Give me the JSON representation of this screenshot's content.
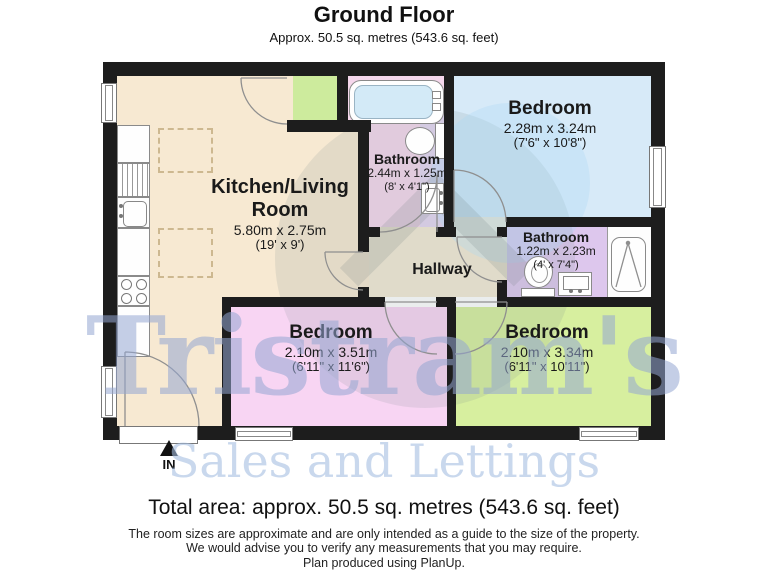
{
  "header": {
    "title": "Ground Floor",
    "subtitle": "Approx. 50.5 sq. metres (543.6 sq. feet)"
  },
  "rooms": {
    "kitchen": {
      "name": "Kitchen/Living Room",
      "dims": "5.80m x 2.75m",
      "imperial": "(19' x 9')",
      "color": "#f7e9d2"
    },
    "bathroom_top": {
      "name": "Bathroom",
      "dims": "2.44m x 1.25m",
      "imperial": "(8' x 4'1\")",
      "color": "#f5d7ec",
      "accent": "#e4d6f1"
    },
    "bedroom_top": {
      "name": "Bedroom",
      "dims": "2.28m x 3.24m",
      "imperial": "(7'6\" x 10'8\")",
      "color": "#d7eaf8"
    },
    "bathroom_mid": {
      "name": "Bathroom",
      "dims": "1.22m x 2.23m",
      "imperial": "(4' x 7'4\")",
      "color": "#ddc7ed"
    },
    "hallway": {
      "name": "Hallway",
      "color": "#f3ead6"
    },
    "bedroom_left": {
      "name": "Bedroom",
      "dims": "2.10m x 3.51m",
      "imperial": "(6'11\" x 11'6\")",
      "color": "#f8d5f3"
    },
    "bedroom_right": {
      "name": "Bedroom",
      "dims": "2.10m x 3.34m",
      "imperial": "(6'11\" x 10'11\")",
      "color": "#d7ef9f"
    },
    "porch": {
      "color": "#cdeb9d"
    }
  },
  "entrance": {
    "label": "IN"
  },
  "watermark": {
    "name": "Tristram's",
    "tagline": "Sales and Lettings"
  },
  "footer": {
    "total_area": "Total area: approx. 50.5 sq. metres (543.6 sq. feet)",
    "disclaimer_line1": "The room sizes are approximate and are only intended as a guide to the size of the property.",
    "disclaimer_line2": "We would advise you to verify any measurements that you may require.",
    "disclaimer_line3": "Plan produced using PlanUp."
  }
}
